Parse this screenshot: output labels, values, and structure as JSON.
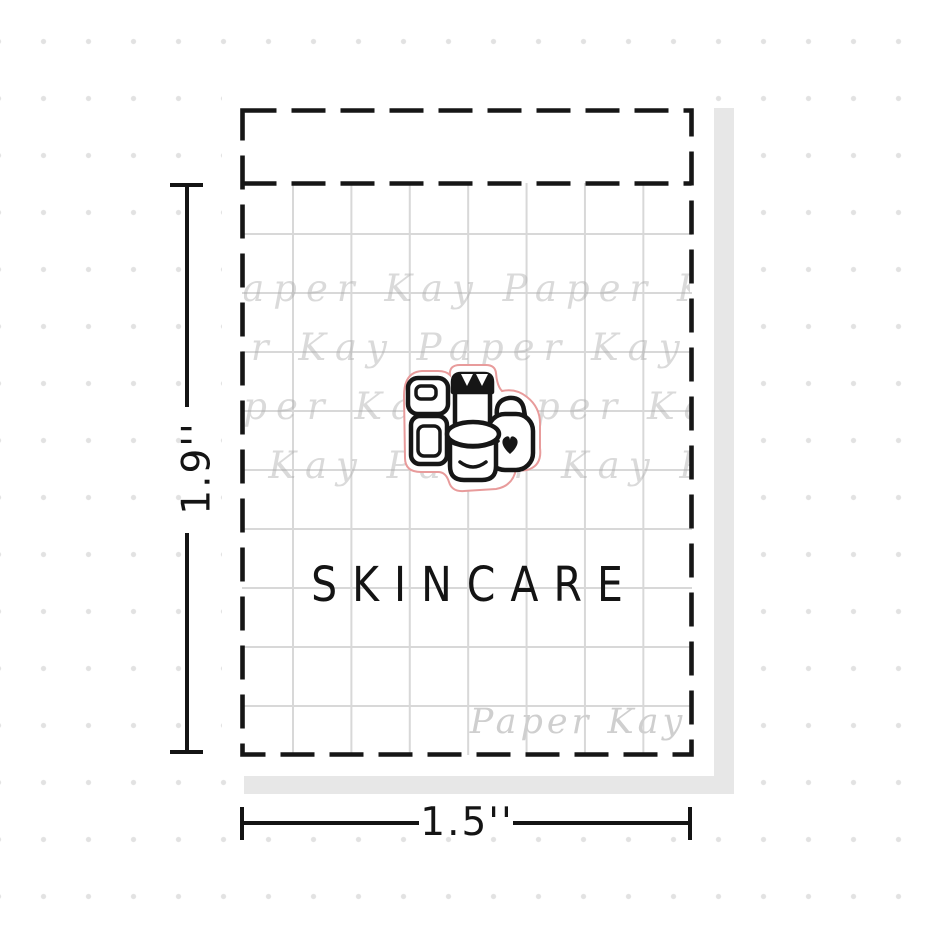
{
  "sticker": {
    "label": "SKINCARE",
    "icon": "skincare-products",
    "cutline_color": "#e89b9b"
  },
  "sheet": {
    "signature_watermark": "Paper Kay",
    "watermark_row_text": "Paper Kay   Paper Kay   Paper Kay   Paper Kay"
  },
  "dimensions": {
    "height_label": "1.9''",
    "width_label": "1.5''"
  },
  "colors": {
    "ink": "#161616",
    "grid_line": "#d8d8d8",
    "background_dot": "#e2e2e2",
    "sheet_shadow": "#e7e7e7",
    "watermark_gray": "#cfcfcf"
  }
}
